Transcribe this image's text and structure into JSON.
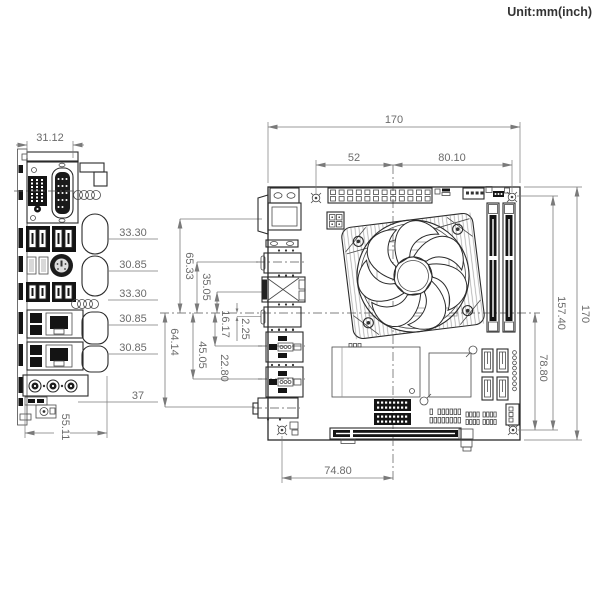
{
  "unit_label": "Unit:mm(inch)",
  "dims": {
    "rear": {
      "width": "31.12",
      "rows": [
        "33.30",
        "30.85",
        "33.30",
        "30.85",
        "30.85",
        "37"
      ],
      "bottom": "55.11"
    },
    "edge": {
      "above": [
        "65.33",
        "35.05",
        "16.17",
        "2.25"
      ],
      "below": [
        "64.14",
        "45.05",
        "22.80"
      ]
    },
    "board": {
      "width": "170",
      "left": "52",
      "right": "80.10",
      "height": "170",
      "holes": "157.40",
      "center": "78.80",
      "bottom": "74.80"
    }
  }
}
